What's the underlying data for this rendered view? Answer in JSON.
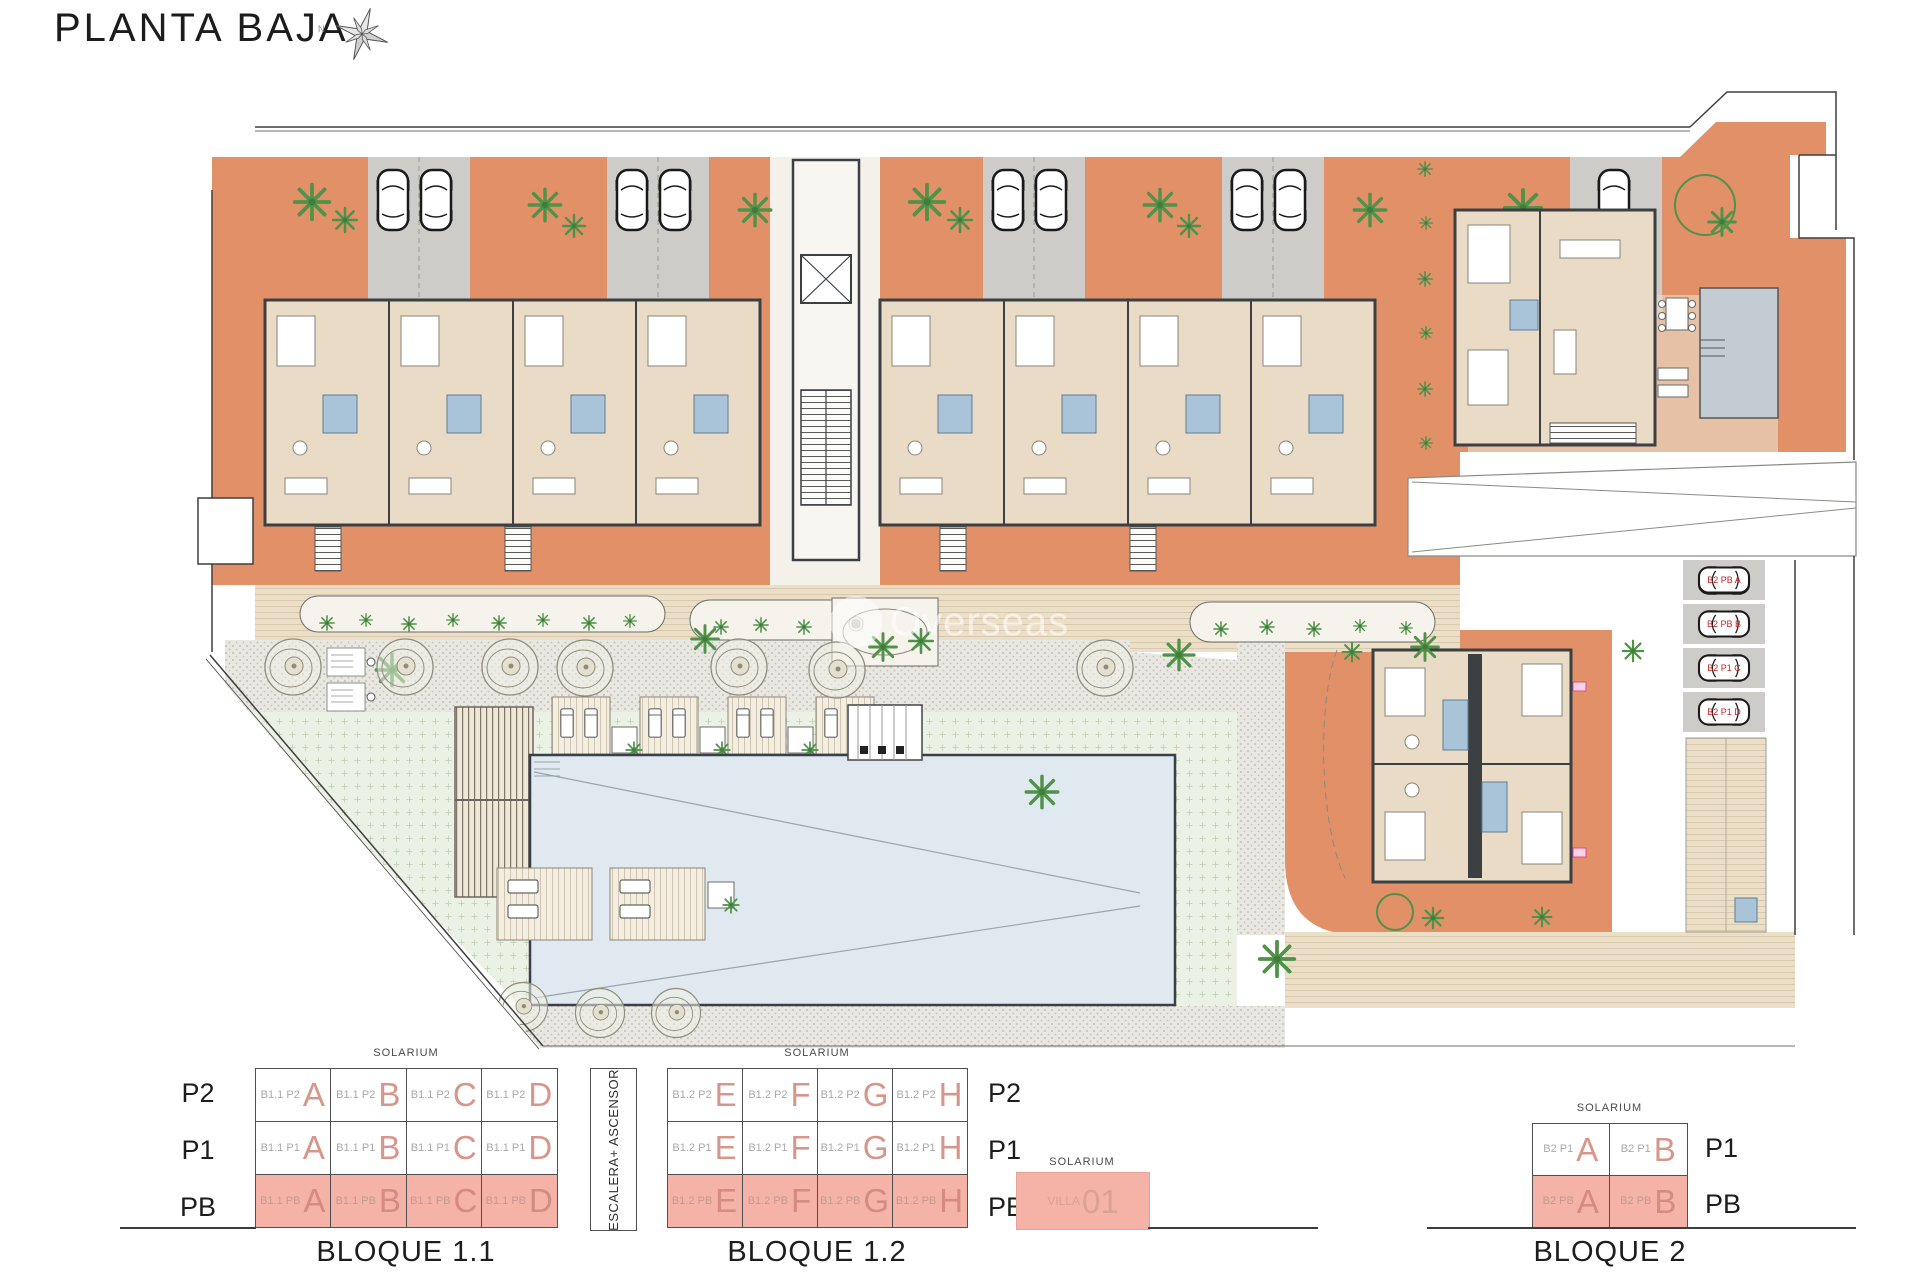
{
  "header": {
    "title": "PLANTA BAJA",
    "compass_label": "N"
  },
  "watermark": {
    "text": "Overseas",
    "logo": "globe-icon"
  },
  "plan": {
    "colors": {
      "terrace_orange": "#e29068",
      "parking_gray": "#cdccc8",
      "interior_beige": "#eadbc6",
      "wall_dark": "#3c4043",
      "bath_blue": "#a9c3d8",
      "pool_blue": "#dfe9ef",
      "villa_pool_gray": "#c2ccd2",
      "lawn_green": "#ecf1e5",
      "path_beige": "#ecdfc8",
      "gravel_gray": "#e9e7e2",
      "plant_green": "#4f9248",
      "highlight_pink": "#f5b2a7"
    },
    "parking_space_labels": [
      "B2 PB A",
      "B2 PB B",
      "B2 P1 C",
      "B2 P1 D"
    ]
  },
  "schematic": {
    "solarium_label": "SOLARIUM",
    "stairs_label": "ESCALERA+ ASCENSOR",
    "floor_labels_left": [
      "P2",
      "P1",
      "PB"
    ],
    "floor_labels_mid": [
      "P2",
      "P1",
      "PB"
    ],
    "floor_labels_right": [
      "P1",
      "PB"
    ],
    "blocks": [
      {
        "name": "BLOQUE 1.1",
        "prefix": "B1.1",
        "rows": [
          "P2",
          "P1",
          "PB"
        ],
        "units": [
          "A",
          "B",
          "C",
          "D"
        ],
        "ground_row": "PB"
      },
      {
        "name": "BLOQUE 1.2",
        "prefix": "B1.2",
        "rows": [
          "P2",
          "P1",
          "PB"
        ],
        "units": [
          "E",
          "F",
          "G",
          "H"
        ],
        "ground_row": "PB"
      },
      {
        "name": "BLOQUE 2",
        "prefix": "B2",
        "rows": [
          "P1",
          "PB"
        ],
        "units": [
          "A",
          "B"
        ],
        "ground_row": "PB"
      }
    ],
    "villa": {
      "solarium": "SOLARIUM",
      "name": "VILLA",
      "number": "01"
    }
  }
}
